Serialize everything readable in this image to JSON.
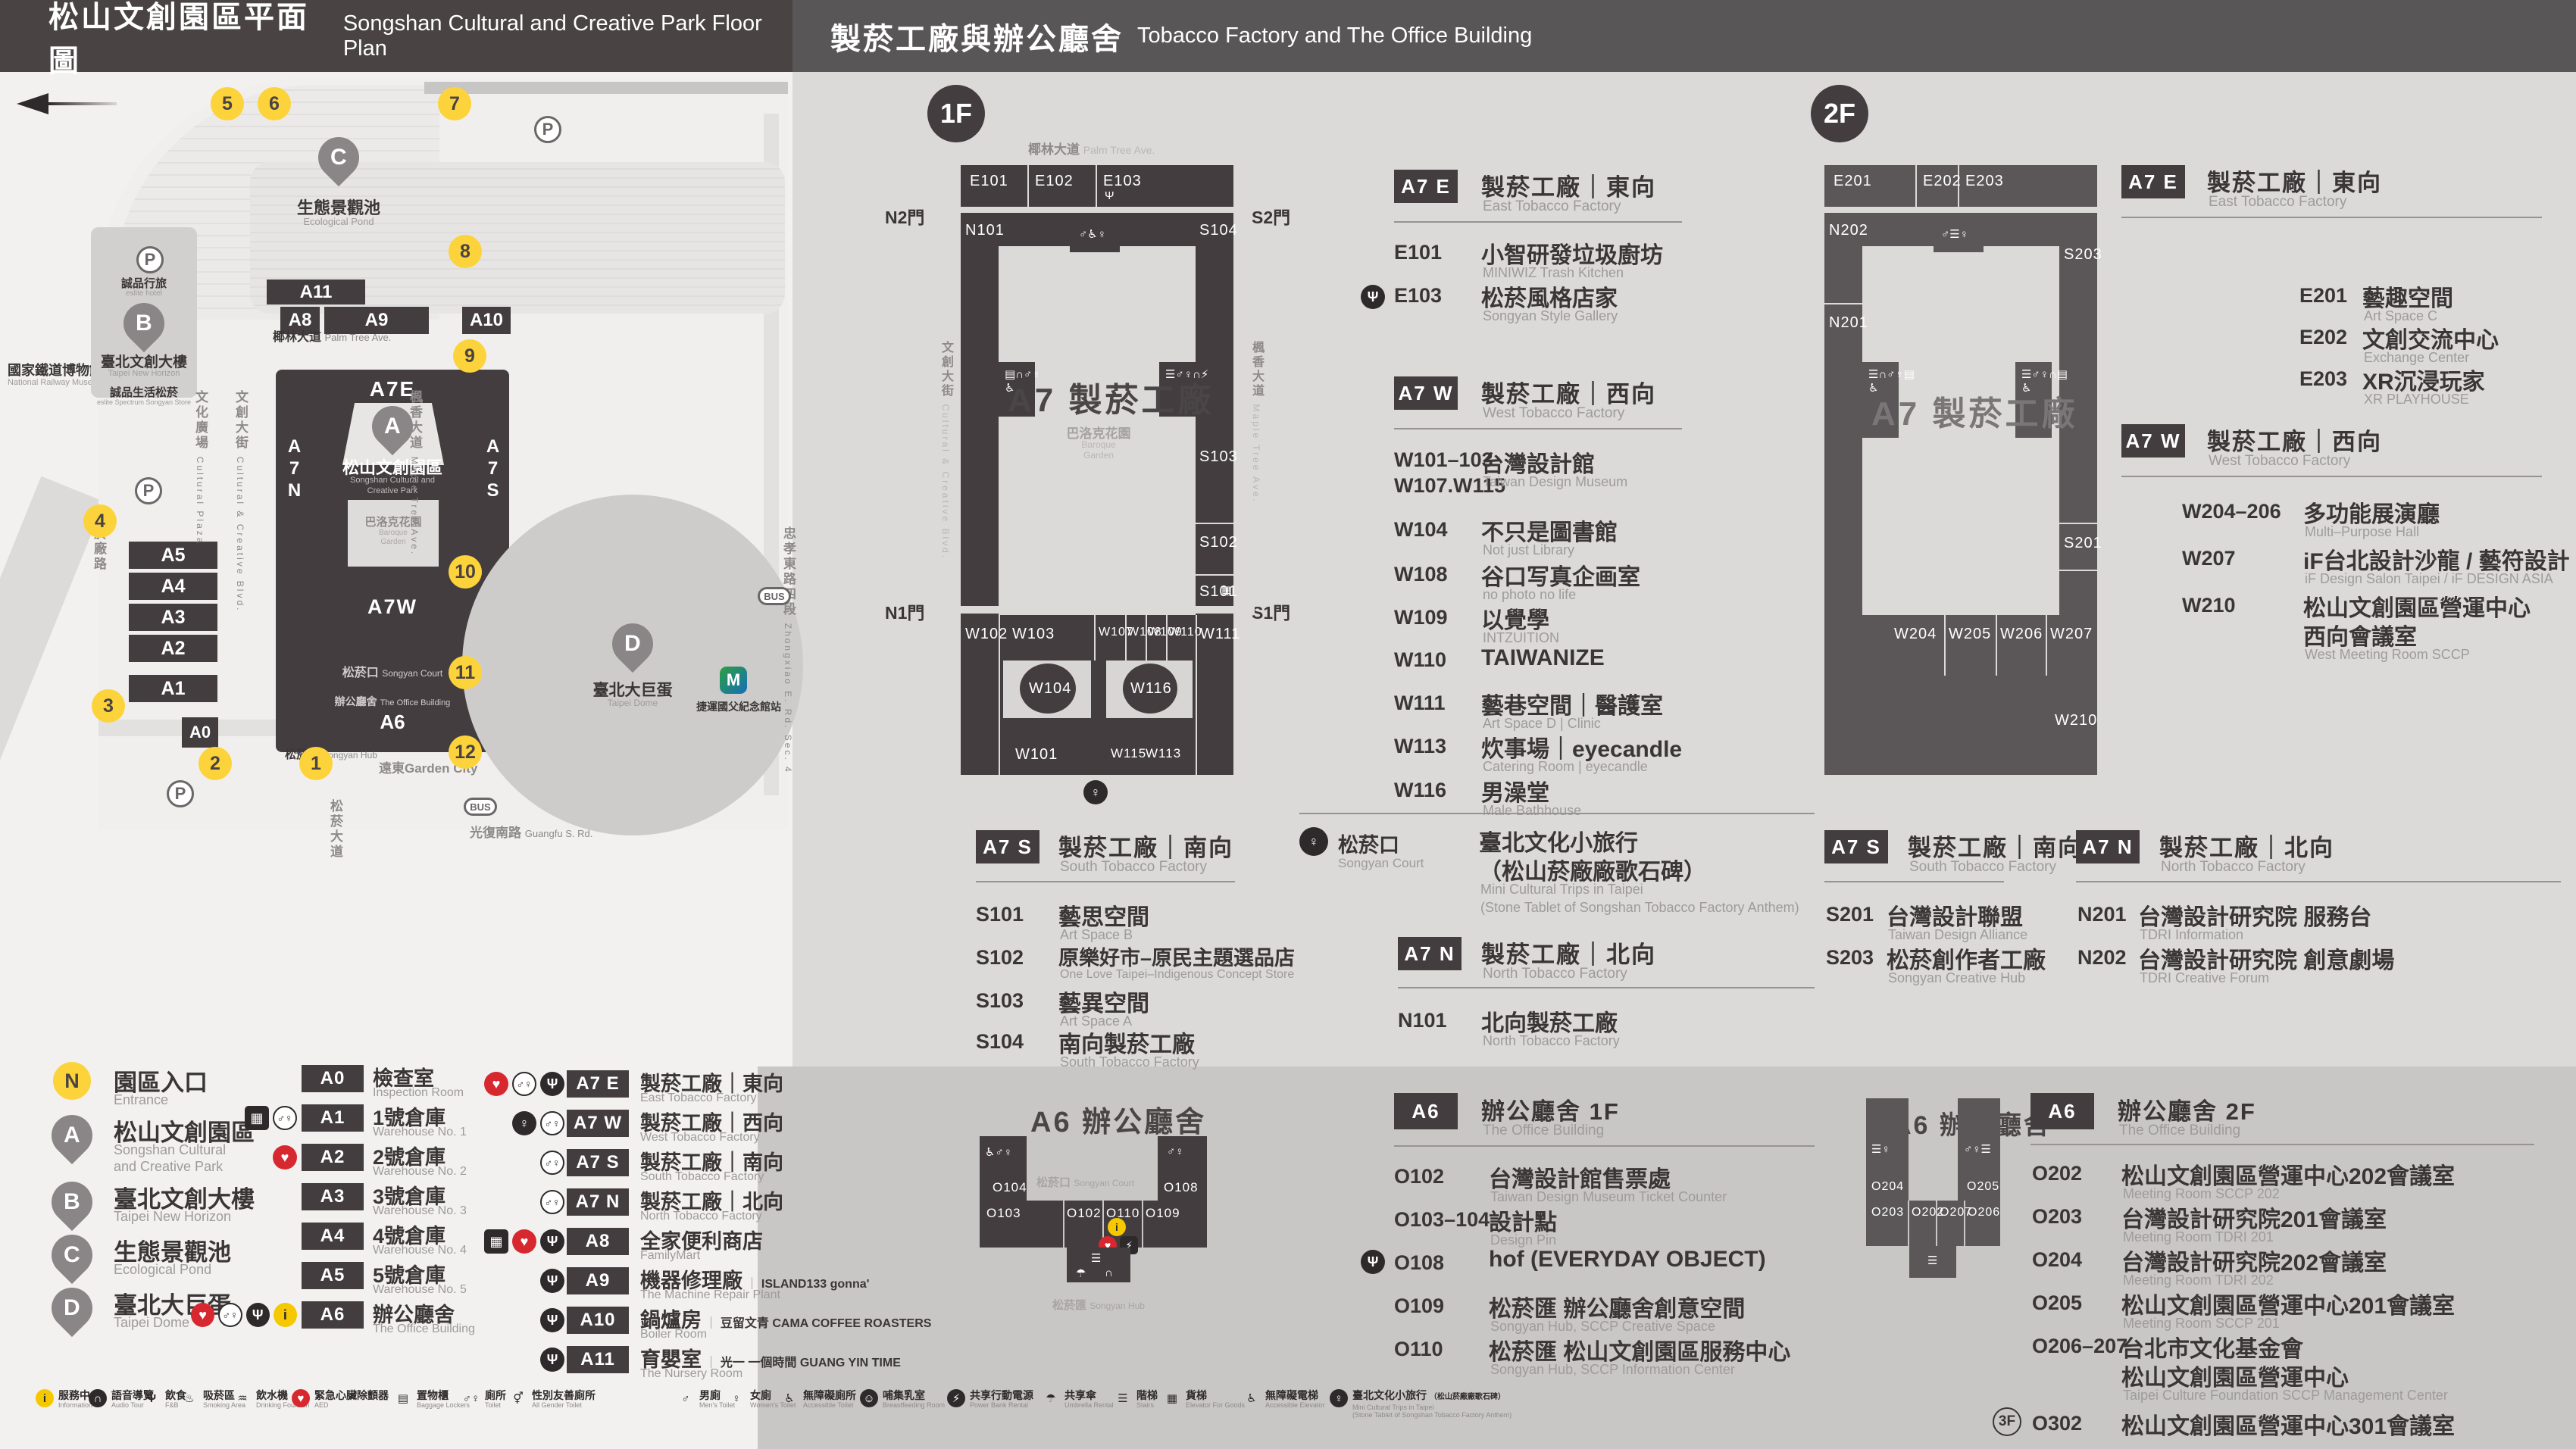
{
  "header": {
    "left_zh": "松山文創園區平面圖",
    "left_en": "Songshan Cultural and Creative Park Floor Plan",
    "right_zh": "製菸工廠與辦公廳舍",
    "right_en": "Tobacco Factory and The Office Building"
  },
  "icons": {
    "north": "N",
    "info": "i",
    "aed": "♥",
    "food": "Ψ",
    "toilet": "♂♀",
    "men": "♂",
    "women": "♀",
    "accessible": "♿",
    "elevator": "▦",
    "goods_elevator": "▦",
    "trips": "♀",
    "audio": "∩",
    "smoking": "♨",
    "water": "♒",
    "lockers": "▤",
    "all_gender": "⚥",
    "nursing": "☺",
    "power": "⚡",
    "umbrella": "☂",
    "stairs": "☰",
    "parking": "P",
    "mrt": "M",
    "bus": "BUS"
  },
  "map": {
    "railway_zh": "國家鐵道博物館",
    "railway_en": "National Railway Museum",
    "pond_pin": "C",
    "pond_zh": "生態景觀池",
    "pond_en": "Ecological Pond",
    "horizon_pin": "B",
    "hotel_zh": "誠品行旅",
    "hotel_en": "eslite hotel",
    "horizon_zh": "臺北文創大樓",
    "horizon_en": "Taipei New Horizon",
    "spectrum_zh": "誠品生活松菸",
    "spectrum_en": "eslite Spectrum Songyan Store",
    "park_pin": "A",
    "park_zh": "松山文創園區",
    "park_en1": "Songshan Cultural and",
    "park_en2": "Creative Park",
    "dome_pin": "D",
    "dome_zh": "臺北大巨蛋",
    "dome_en": "Taipei Dome",
    "garden_city": "遠東Garden City",
    "mrt_station": "捷運國父紀念館站",
    "a7e": "A7E",
    "a7w": "A7W",
    "a7n": "A7N",
    "a7s": "A7S",
    "a6": "A6",
    "a0": "A0",
    "baroque_zh": "巴洛克花園",
    "baroque_en1": "Baroque",
    "baroque_en2": "Garden",
    "court_zh": "松菸口",
    "court_en": "Songyan Court",
    "office_zh": "辦公廳舍",
    "office_en": "The Office Building",
    "hub_zh": "松菸匯",
    "hub_en": "Songyan Hub",
    "bars": {
      "a11": "A11",
      "a8": "A8",
      "a9": "A9",
      "a10": "A10",
      "a5": "A5",
      "a4": "A4",
      "a3": "A3",
      "a2": "A2",
      "a1": "A1"
    },
    "streets": {
      "palm_zh": "椰林大道",
      "palm_en": "Palm Tree Ave.",
      "plaza_zh": "文化廣場",
      "plaza_en": "Cultural Plaza",
      "cc_zh": "文創大街",
      "cc_en": "Cultural & Creative Blvd.",
      "maple_zh": "楓香大道",
      "maple_en": "Maple Tree Ave.",
      "yanchang": "菸廠路",
      "songyan": "松菸大道",
      "zhongxiao_zh": "忠孝東路四段",
      "zhongxiao_en": "Zhongxiao E. Rd. Sec. 4",
      "guangfu_zh": "光復南路",
      "guangfu_en": "Guangfu S. Rd."
    },
    "entrances": [
      "5",
      "6",
      "7",
      "8",
      "9",
      "4",
      "10",
      "11",
      "3",
      "12",
      "2",
      "1"
    ]
  },
  "legend_points": [
    {
      "badge": "N",
      "zh": "園區入口",
      "en": "Entrance"
    },
    {
      "badge": "A",
      "zh": "松山文創園區",
      "en1": "Songshan Cultural",
      "en2": "and Creative Park"
    },
    {
      "badge": "B",
      "zh": "臺北文創大樓",
      "en1": "Taipei New Horizon",
      "en2": ""
    },
    {
      "badge": "C",
      "zh": "生態景觀池",
      "en1": "Ecological Pond",
      "en2": ""
    },
    {
      "badge": "D",
      "zh": "臺北大巨蛋",
      "en1": "Taipei Dome",
      "en2": ""
    }
  ],
  "legend_a": [
    {
      "code": "A0",
      "zh": "檢查室",
      "en": "Inspection Room",
      "icons": []
    },
    {
      "code": "A1",
      "zh": "1號倉庫",
      "en": "Warehouse No. 1",
      "icons": [
        "elevator",
        "toilet"
      ]
    },
    {
      "code": "A2",
      "zh": "2號倉庫",
      "en": "Warehouse No. 2",
      "icons": [
        "aed"
      ]
    },
    {
      "code": "A3",
      "zh": "3號倉庫",
      "en": "Warehouse No. 3",
      "icons": []
    },
    {
      "code": "A4",
      "zh": "4號倉庫",
      "en": "Warehouse No. 4",
      "icons": []
    },
    {
      "code": "A5",
      "zh": "5號倉庫",
      "en": "Warehouse No. 5",
      "icons": []
    },
    {
      "code": "A6",
      "zh": "辦公廳舍",
      "en": "The Office Building",
      "icons": [
        "aed",
        "toilet",
        "food",
        "info"
      ]
    }
  ],
  "legend_b": [
    {
      "code": "A7 E",
      "zh": "製菸工廠｜東向",
      "en": "East Tobacco Factory",
      "sub": "",
      "icons": [
        "aed",
        "toilet",
        "food"
      ]
    },
    {
      "code": "A7 W",
      "zh": "製菸工廠｜西向",
      "en": "West Tobacco Factory",
      "sub": "",
      "icons": [
        "trips",
        "toilet"
      ]
    },
    {
      "code": "A7 S",
      "zh": "製菸工廠｜南向",
      "en": "South Tobacco Factory",
      "sub": "",
      "icons": [
        "toilet"
      ]
    },
    {
      "code": "A7 N",
      "zh": "製菸工廠｜北向",
      "en": "North Tobacco Factory",
      "sub": "",
      "icons": [
        "toilet"
      ]
    },
    {
      "code": "A8",
      "zh": "全家便利商店",
      "en": "FamilyMart",
      "sub": "",
      "icons": [
        "elevator",
        "aed",
        "food"
      ]
    },
    {
      "code": "A9",
      "zh": "機器修理廠",
      "en": "The Machine Repair Plant",
      "sub": "ISLAND133 gonna'",
      "icons": [
        "food"
      ]
    },
    {
      "code": "A10",
      "zh": "鍋爐房",
      "en": "Boiler Room",
      "sub": "豆留文青 CAMA COFFEE ROASTERS",
      "icons": [
        "food"
      ]
    },
    {
      "code": "A11",
      "zh": "育嬰室",
      "en": "The Nursery Room",
      "sub": "光一 一個時間 GUANG YIN TIME",
      "icons": [
        "food"
      ]
    }
  ],
  "facilities": [
    {
      "zh": "服務中心",
      "en": "Information",
      "icon": "info"
    },
    {
      "zh": "語音導覽",
      "en": "Audio Tour",
      "icon": "audio"
    },
    {
      "zh": "飲食",
      "en": "F&B",
      "icon": "food"
    },
    {
      "zh": "吸菸區",
      "en": "Smoking Area",
      "icon": "smoking"
    },
    {
      "zh": "飲水機",
      "en": "Drinking Fountain",
      "icon": "water"
    },
    {
      "zh": "緊急心臟除顫器",
      "en": "AED",
      "icon": "aed"
    },
    {
      "zh": "置物櫃",
      "en": "Baggage Lockers",
      "icon": "lockers"
    },
    {
      "zh": "廁所",
      "en": "Toilet",
      "icon": "toilet"
    },
    {
      "zh": "性別友善廁所",
      "en": "All Gender Toilet",
      "icon": "all_gender"
    },
    {
      "zh": "男廁",
      "en": "Men's Toilet",
      "icon": "men"
    },
    {
      "zh": "女廁",
      "en": "Women's Toilet",
      "icon": "women"
    },
    {
      "zh": "無障礙廁所",
      "en": "Accessible Toilet",
      "icon": "accessible"
    },
    {
      "zh": "哺集乳室",
      "en": "Breastfeeding Room",
      "icon": "nursing"
    },
    {
      "zh": "共享行動電源",
      "en": "Power Bank Rental",
      "icon": "power"
    },
    {
      "zh": "共享傘",
      "en": "Umbrella Rental",
      "icon": "umbrella"
    },
    {
      "zh": "階梯",
      "en": "Stairs",
      "icon": "stairs"
    },
    {
      "zh": "貨梯",
      "en": "Elevator For Goods",
      "icon": "goods_elevator"
    },
    {
      "zh": "無障礙電梯",
      "en": "Accessible Elevator",
      "icon": "accessible"
    },
    {
      "zh": "臺北文化小旅行",
      "zh_sub": "（松山菸廠廠歌石碑）",
      "en": "Mini Cultural Trips in Taipei",
      "en_sub": "(Stone Tablet of Songshan Tobacco Factory Anthem)",
      "icon": "trips"
    }
  ],
  "f1": {
    "badge": "1F",
    "street_top_zh": "椰林大道",
    "street_top_en": "Palm Tree Ave.",
    "street_left_zh": "文創大街",
    "street_left_en": "Cultural & Creative Blvd.",
    "street_right_zh": "楓香大道",
    "street_right_en": "Maple Tree Ave.",
    "gate_n2": "N2門",
    "gate_s2": "S2門",
    "gate_n1": "N1門",
    "gate_s1": "S1門",
    "plan_title": "A7 製菸工廠",
    "baroque_zh": "巴洛克花園",
    "baroque_en1": "Baroque",
    "baroque_en2": "Garden",
    "rooms": {
      "e101": "E101",
      "e102": "E102",
      "e103": "E103",
      "n101": "N101",
      "s104": "S104",
      "s103": "S103",
      "s102": "S102",
      "s101": "S101",
      "w102": "W102",
      "w103": "W103",
      "w107": "W107",
      "w108": "W108",
      "w109": "W109",
      "w110": "W110",
      "w111": "W111",
      "w104": "W104",
      "w116": "W116",
      "w101": "W101",
      "w115": "W115",
      "w113": "W113"
    }
  },
  "f2": {
    "badge": "2F",
    "plan_title": "A7 製菸工廠",
    "rooms": {
      "e201": "E201",
      "e202": "E202",
      "e203": "E203",
      "n202": "N202",
      "n201": "N201",
      "s203": "S203",
      "s201": "S201",
      "w204": "W204",
      "w205": "W205",
      "w206": "W206",
      "w207": "W207",
      "w210": "W210"
    }
  },
  "a6f1_plan": {
    "title": "A6 辦公廳舍",
    "court_zh": "松菸口",
    "court_en": "Songyan Court",
    "hub_zh": "松菸匯",
    "hub_en": "Songyan Hub",
    "rooms": {
      "o104": "O104",
      "o108": "O108",
      "o103": "O103",
      "o102": "O102",
      "o110": "O110",
      "o109": "O109"
    }
  },
  "a6f2_plan": {
    "title": "A6 辦公廳舍",
    "rooms": {
      "o204": "O204",
      "o205": "O205",
      "o203": "O203",
      "o202": "O202",
      "o207": "O207",
      "o206": "O206"
    }
  },
  "lists": {
    "f1_a7e": {
      "badge": "A7 E",
      "zh": "製菸工廠｜東向",
      "en": "East Tobacco Factory",
      "items": [
        {
          "code": "E101",
          "zh": "小智研發垃圾廚坊",
          "en": "MINIWIZ Trash Kitchen"
        },
        {
          "code": "E103",
          "zh": "松菸風格店家",
          "en": "Songyan Style Gallery"
        }
      ]
    },
    "f1_a7w": {
      "badge": "A7 W",
      "zh": "製菸工廠｜西向",
      "en": "West Tobacco Factory",
      "items": [
        {
          "code": "W101–103",
          "code2": "W107.W115",
          "zh": "台灣設計館",
          "en": "Taiwan Design Museum"
        },
        {
          "code": "W104",
          "zh": "不只是圖書館",
          "en": "Not just Library"
        },
        {
          "code": "W108",
          "zh": "谷口写真企画室",
          "en": "no photo no life"
        },
        {
          "code": "W109",
          "zh": "以覺學",
          "en": "INTZUITION"
        },
        {
          "code": "W110",
          "zh": "TAIWANIZE",
          "en": ""
        },
        {
          "code": "W111",
          "zh": "藝巷空間｜醫護室",
          "en": "Art Space D | Clinic"
        },
        {
          "code": "W113",
          "zh": "炊事場｜eyecandle",
          "en": "Catering Room | eyecandle"
        },
        {
          "code": "W116",
          "zh": "男澡堂",
          "en": "Male Bathhouse"
        }
      ]
    },
    "f1_a7s": {
      "badge": "A7 S",
      "zh": "製菸工廠｜南向",
      "en": "South Tobacco Factory",
      "items": [
        {
          "code": "S101",
          "zh": "藝思空間",
          "en": "Art Space B"
        },
        {
          "code": "S102",
          "zh": "原樂好市–原民主題選品店",
          "en": "One Love Taipei–Indigenous Concept Store"
        },
        {
          "code": "S103",
          "zh": "藝異空間",
          "en": "Art Space A"
        },
        {
          "code": "S104",
          "zh": "南向製菸工廠",
          "en": "South Tobacco Factory"
        }
      ]
    },
    "court": {
      "zh": "松菸口",
      "en": "Songyan Court",
      "name_zh1": "臺北文化小旅行",
      "name_zh2": "（松山菸廠廠歌石碑）",
      "name_en1": "Mini Cultural Trips in Taipei",
      "name_en2": "(Stone Tablet of Songshan Tobacco Factory Anthem)"
    },
    "f1_a7n": {
      "badge": "A7 N",
      "zh": "製菸工廠｜北向",
      "en": "North Tobacco Factory",
      "items": [
        {
          "code": "N101",
          "zh": "北向製菸工廠",
          "en": "North Tobacco Factory"
        }
      ]
    },
    "a6f1": {
      "badge": "A6",
      "zh": "辦公廳舍 1F",
      "en": "The Office Building",
      "items": [
        {
          "code": "O102",
          "zh": "台灣設計館售票處",
          "en": "Taiwan Design Museum Ticket Counter"
        },
        {
          "code": "O103–104",
          "zh": "設計點",
          "en": "Design Pin"
        },
        {
          "code": "O108",
          "zh": "hof (EVERYDAY OBJECT)",
          "en": ""
        },
        {
          "code": "O109",
          "zh": "松菸匯 辦公廳舍創意空間",
          "en": "Songyan Hub, SCCP Creative Space"
        },
        {
          "code": "O110",
          "zh": "松菸匯 松山文創園區服務中心",
          "en": "Songyan Hub, SCCP Information Center"
        }
      ]
    },
    "f2_a7e": {
      "badge": "A7 E",
      "zh": "製菸工廠｜東向",
      "en": "East Tobacco Factory",
      "items": [
        {
          "code": "E201",
          "zh": "藝趣空間",
          "en": "Art Space C"
        },
        {
          "code": "E202",
          "zh": "文創交流中心",
          "en": "Exchange Center"
        },
        {
          "code": "E203",
          "zh": "XR沉浸玩家",
          "en": "XR PLAYHOUSE"
        }
      ]
    },
    "f2_a7w": {
      "badge": "A7 W",
      "zh": "製菸工廠｜西向",
      "en": "West Tobacco Factory",
      "items": [
        {
          "code": "W204–206",
          "zh": "多功能展演廳",
          "en": "Multi–Purpose Hall"
        },
        {
          "code": "W207",
          "zh": "iF台北設計沙龍 / 藝符設計",
          "en": "iF Design Salon Taipei / iF DESIGN ASIA"
        },
        {
          "code": "W210",
          "zh": "松山文創園區營運中心",
          "zh2": "西向會議室",
          "en": "West Meeting Room SCCP"
        }
      ]
    },
    "f2_a7s": {
      "badge": "A7 S",
      "zh": "製菸工廠｜南向",
      "en": "South Tobacco Factory",
      "items": [
        {
          "code": "S201",
          "zh": "台灣設計聯盟",
          "en": "Taiwan Design Alliance"
        },
        {
          "code": "S203",
          "zh": "松菸創作者工廠",
          "en": "Songyan Creative Hub"
        }
      ]
    },
    "f2_a7n": {
      "badge": "A7 N",
      "zh": "製菸工廠｜北向",
      "en": "North Tobacco Factory",
      "items": [
        {
          "code": "N201",
          "zh": "台灣設計研究院 服務台",
          "en": "TDRI Information"
        },
        {
          "code": "N202",
          "zh": "台灣設計研究院 創意劇場",
          "en": "TDRI Creative Forum"
        }
      ]
    },
    "a6f2": {
      "badge": "A6",
      "zh": "辦公廳舍 2F",
      "en": "The Office Building",
      "items": [
        {
          "code": "O202",
          "zh": "松山文創園區營運中心202會議室",
          "en": "Meeting Room SCCP 202"
        },
        {
          "code": "O203",
          "zh": "台灣設計研究院201會議室",
          "en": "Meeting Room TDRI 201"
        },
        {
          "code": "O204",
          "zh": "台灣設計研究院202會議室",
          "en": "Meeting Room TDRI 202"
        },
        {
          "code": "O205",
          "zh": "松山文創園區營運中心201會議室",
          "en": "Meeting Room SCCP 201"
        },
        {
          "code": "O206–207",
          "zh": "台北市文化基金會",
          "zh2": "松山文創園區營運中心",
          "en": "Taipei Culture Foundation SCCP Management Center"
        },
        {
          "floor": "3F",
          "code": "O302",
          "zh": "松山文創園區營運中心301會議室",
          "en": "Meeting Room SCCP 301"
        }
      ]
    }
  }
}
